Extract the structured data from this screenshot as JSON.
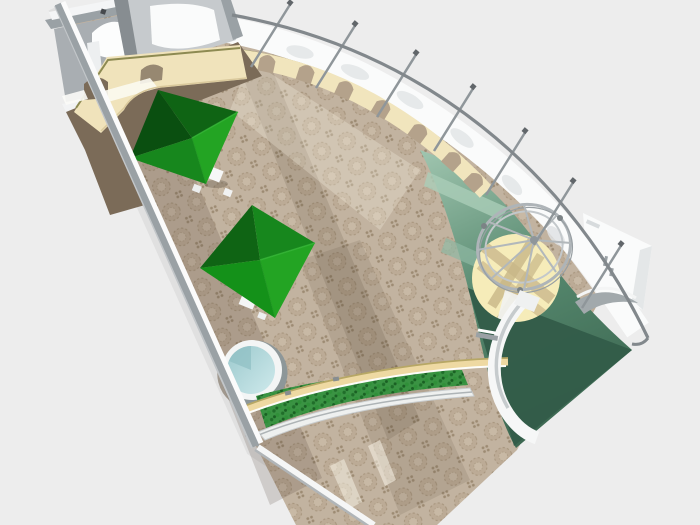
{
  "scene": {
    "kind": "aerial-3d-architectural-render",
    "objects": [
      "back-rooms",
      "service-counter",
      "arched-arcade-wall",
      "perimeter-railing",
      "railing-posts",
      "tiled-floor",
      "canopy-pyramid-1",
      "canopy-pyramid-2",
      "cafe-tables",
      "round-pool",
      "hedge-planter",
      "curved-bench-wall",
      "green-terrace-floor",
      "gazebo-dome-frame",
      "gazebo-floor",
      "curved-ramp",
      "white-utility-structure",
      "left-boundary-wall"
    ]
  },
  "colors": {
    "background": "#ededed",
    "exterior_shadow": "rgba(0,0,0,0.05)",
    "tile_base": "#c2b3a0",
    "tile_motif": "#a6947c",
    "floor_dark_brown": "#7b6b58",
    "counter_cream": "#f0e3bb",
    "arcade_cream": "#f1e5bd",
    "arch_opening": "#b4a28b",
    "olive_edge": "#8d8a52",
    "wall_gray": "#9aa1a5",
    "wall_gray_dark": "#878d91",
    "wall_gray_light": "#c6cacd",
    "white_surface": "#fafbfb",
    "rail_gray": "#82888c",
    "frame_gray": "#aeb4b8",
    "canopy_bright": "#23a423",
    "canopy_mid": "#17871d",
    "canopy_dark": "#0f6414",
    "canopy_deepdark": "#0a4f10",
    "pool_water": "#aed8db",
    "pool_rim": "#f3f5f5",
    "hedge_green": "#3a9343",
    "hedge_shade": "#1d6a27",
    "bench_cream": "#eed9a2",
    "bench_edge": "#b7a765",
    "terrace_light": "#9ec4ae",
    "terrace_mid": "#55876d",
    "terrace_dark": "#3a654f",
    "terrace_deep": "#335c49",
    "gazebo_floor": "#f6ecb9",
    "gazebo_band": "#cdbb8e",
    "ramp_white": "#f6f7f7",
    "shadow_tint": "rgba(74,58,42,0.18)",
    "highlight_tint": "rgba(255,252,240,0.45)"
  }
}
